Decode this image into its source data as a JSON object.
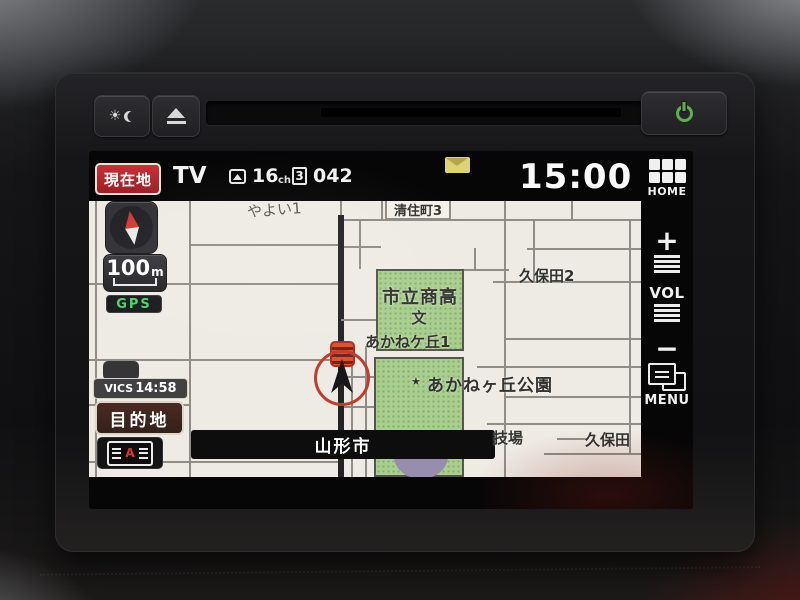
{
  "status_bar": {
    "current_location_button": "現在地",
    "source": "TV",
    "channel": "16",
    "channel_unit": "ch",
    "preset": "3",
    "subchannel": "042",
    "clock": "15:00"
  },
  "side_panel": {
    "home": "HOME",
    "volume_up": "+",
    "volume": "VOL",
    "volume_down": "−",
    "menu": "MENU"
  },
  "map_controls": {
    "scale": "100",
    "scale_unit": "m",
    "gps": "GPS",
    "vics": "VICS",
    "vics_time": "14:58",
    "destination": "目的地",
    "av_letter": "A"
  },
  "map": {
    "labels": {
      "yayoi": "やよい1",
      "kiyozumi_cho_3": "清住町3",
      "kubota_2": "久保田2",
      "school": "市立商高",
      "school_mark": "文",
      "akanegaoka_1": "あかねケ丘1",
      "park_star": "★",
      "park": "あかねヶ丘公園",
      "city_bar": "山形市",
      "stadium_partial": "技場",
      "kubota": "久保田"
    }
  },
  "icons": {
    "brightness": "sun + crescent moon",
    "eject": "triangle over bar",
    "power": "green power ring",
    "mail": "yellow envelope",
    "tv_signal": "antenna in rounded box",
    "home": "grid of six squares",
    "volume": "stacked bars above and below VOL",
    "menu": "overlapping windows",
    "compass": "red north / white south needle",
    "current_position": "black arrow in red ring",
    "vics_beacon": "striped orange board"
  },
  "colors": {
    "accent_red": "#b0242b",
    "gps_green": "#46d66a",
    "map_bg": "#eeebe4",
    "area_green": "#a8cf8e",
    "marker_ring": "#c23b2e",
    "beacon_orange": "#d4562c",
    "power_green": "#5fae4f",
    "mail_yellow": "#ded277"
  }
}
